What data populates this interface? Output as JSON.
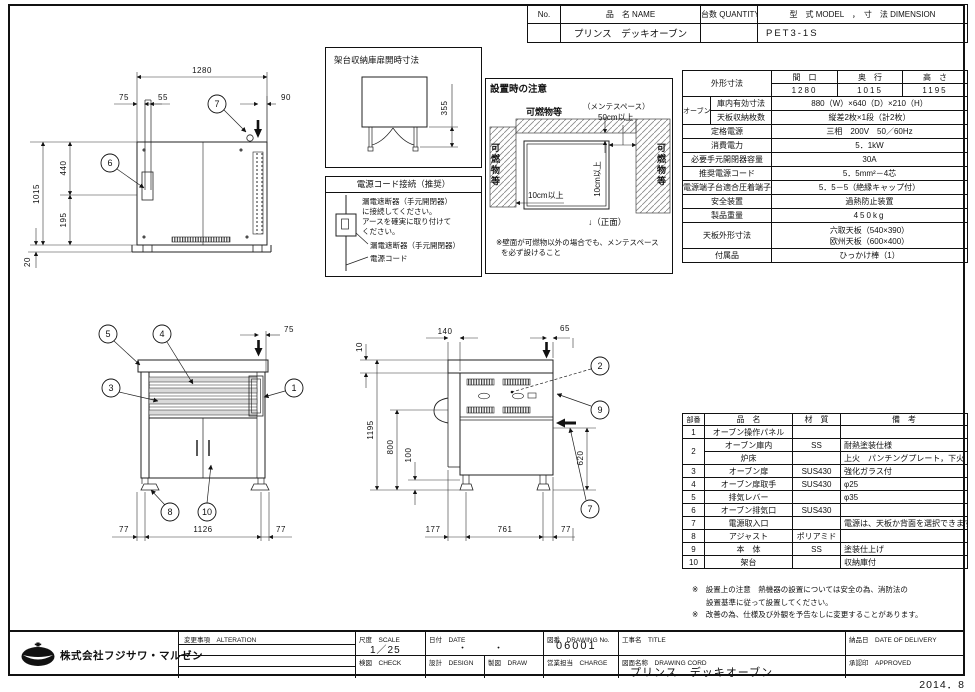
{
  "doc": {
    "stamp": "2014．8"
  },
  "header": {
    "no_label": "No.",
    "name_label": "品　名 NAME",
    "qty_label": "台数 QUANTITY",
    "model_label": "型　式 MODEL　，　寸　法 DIMENSION",
    "name_value": "プリンス　デッキオーブン",
    "qty_value": "",
    "model_value": "PET3-1S"
  },
  "spec": {
    "outer_label": "外形寸法",
    "w_label": "間　口",
    "d_label": "奥　行",
    "h_label": "高　さ",
    "w": "1280",
    "d": "1015",
    "h": "1195",
    "oven_label": "オーブン",
    "inner_label": "庫内有効寸法",
    "inner_value": "880（W）×640（D）×210（H）",
    "tray_label": "天板収納枚数",
    "tray_value": "縦差2枚×1段（計2枚）",
    "rated_label": "定格電源",
    "rated_value": "三相　200V　50／60Hz",
    "power_label": "消費電力",
    "power_value": "5．1kW",
    "breaker_label": "必要手元開閉器容量",
    "breaker_value": "30A",
    "cord_label": "推奨電源コード",
    "cord_value": "5．5mm²－4芯",
    "terminal_label": "電源端子台適合圧着端子",
    "terminal_value": "5．5－5（絶縁キャップ付）",
    "safety_label": "安全装置",
    "safety_value": "過熱防止装置",
    "weight_label": "製品重量",
    "weight_value": "450kg",
    "tray_dim_label": "天板外形寸法",
    "tray_dim_value1": "六取天板（540×390）",
    "tray_dim_value2": "欧州天板（600×400）",
    "acc_label": "付属品",
    "acc_value": "ひっかけ棒（1）"
  },
  "parts": {
    "h_no": "部番",
    "h_name": "品　名",
    "h_mat": "材　質",
    "h_note": "備　考",
    "rows": [
      {
        "no": "1",
        "name": "オーブン操作パネル",
        "mat": "",
        "note": ""
      },
      {
        "no": "2",
        "name": "オーブン庫内",
        "mat": "SS",
        "note": "耐熱塗装仕様"
      },
      {
        "no": "",
        "name": "炉床",
        "mat": "",
        "note": "上火　パンチングプレート，下火　SS"
      },
      {
        "no": "3",
        "name": "オーブン扉",
        "mat": "SUS430",
        "note": "強化ガラス付"
      },
      {
        "no": "4",
        "name": "オーブン扉取手",
        "mat": "SUS430",
        "note": "φ25"
      },
      {
        "no": "5",
        "name": "排気レバー",
        "mat": "",
        "note": "φ35"
      },
      {
        "no": "6",
        "name": "オーブン排気口",
        "mat": "SUS430",
        "note": ""
      },
      {
        "no": "7",
        "name": "電源取入口",
        "mat": "",
        "note": "電源は、天板か背面を選択できます"
      },
      {
        "no": "8",
        "name": "アジャスト",
        "mat": "ポリアミド",
        "note": ""
      },
      {
        "no": "9",
        "name": "本　体",
        "mat": "SS",
        "note": "塗装仕上げ"
      },
      {
        "no": "10",
        "name": "架台",
        "mat": "",
        "note": "収納庫付"
      }
    ]
  },
  "notes": {
    "line1": "※　設置上の注意　熱機器の設置については安全の為、消防法の",
    "line2": "設置基準に従って設置してください。",
    "line3": "※　改善の為、仕様及び外観を予告なしに変更することがあります。"
  },
  "title_block": {
    "company": "株式会社フジサワ・マルゼン",
    "alteration": "変更事項　ALTERATION",
    "scale_label": "尺度　SCALE",
    "scale_value": "1／25",
    "date_label": "日付　DATE",
    "date_value": "・　　　・",
    "dno_label": "図番　DRAWING No.",
    "dno_value": "06001",
    "title_label": "工事名　TITLE",
    "check_label": "検図　CHECK",
    "design_label": "設計　DESIGN",
    "draw_label": "製図　DRAW",
    "charge_label": "営業担当　CHARGE",
    "dname_label": "図面名称　DRAWING CORD",
    "dname_value": "プリンス　デッキオーブン",
    "delivery_label": "納品日　DATE OF DELIVERY",
    "approved_label": "承認印　APPROVED"
  },
  "boxes": {
    "kadai": {
      "title": "架台収納庫扉開時寸法",
      "dim": "355"
    },
    "power": {
      "title": "電源コード接続（推奨）",
      "t1": "漏電遮断器（手元開閉器）",
      "t2": "に接続してください。",
      "t3": "アースを確実に取り付けて",
      "t4": "ください。",
      "l1": "漏電遮断器（手元開閉器）",
      "l2": "電源コード"
    },
    "caution": {
      "title": "設置時の注意",
      "top": "可燃物等",
      "left": "可燃物等",
      "right": "可燃物等",
      "maint": "（メンテスペース）",
      "d50": "50cm以上",
      "d10v": "10cm以上",
      "d10h": "10cm以上",
      "front": "↓（正面）",
      "note1": "※壁面が可燃物以外の場合でも、メンテスペース",
      "note2": "を必ず設けること"
    }
  },
  "views": {
    "top": {
      "d1280": "1280",
      "d75": "75",
      "d55": "55",
      "d90": "90",
      "d1015": "1015",
      "d440": "440",
      "d195": "195",
      "d20": "20",
      "c6": "6",
      "c7": "7"
    },
    "front": {
      "d75": "75",
      "d77_left": "77",
      "d1126": "1126",
      "d77_right": "77",
      "c5": "5",
      "c4": "4",
      "c3": "3",
      "c1": "1",
      "c8": "8",
      "c10": "10"
    },
    "side": {
      "d140": "140",
      "d65": "65",
      "d10": "10",
      "d1195": "1195",
      "d800": "800",
      "d100": "100",
      "d620": "620",
      "d177": "177",
      "d761": "761",
      "d77": "77",
      "c2": "2",
      "c9": "9",
      "c7": "7"
    }
  }
}
